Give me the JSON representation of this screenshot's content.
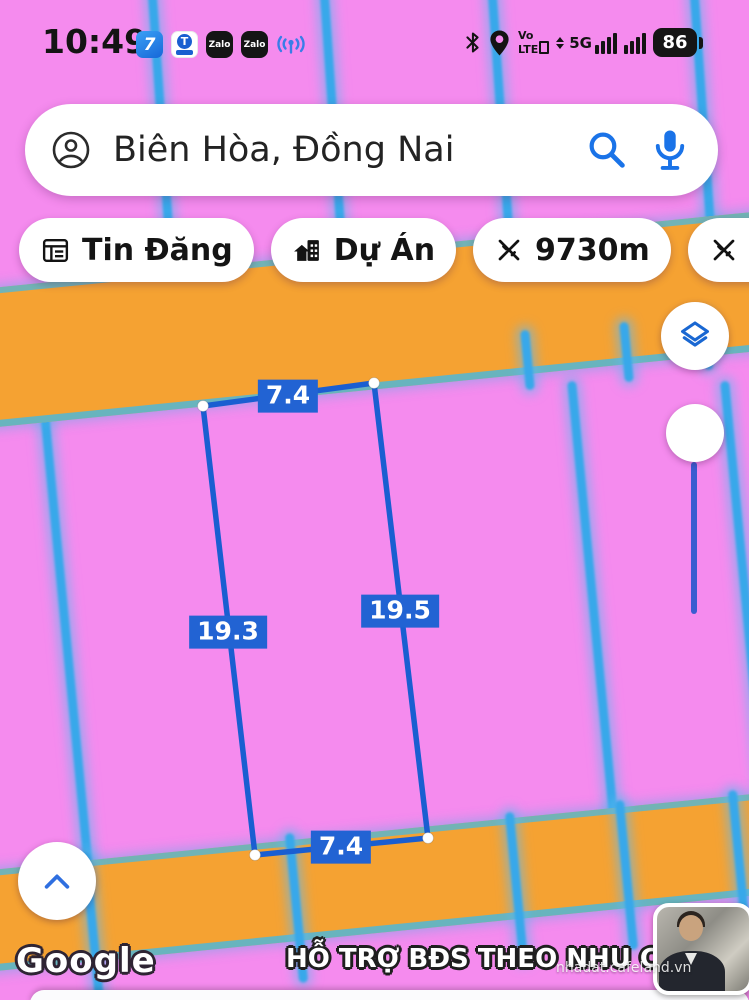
{
  "status_bar": {
    "time": "10:49",
    "app_icon_1_glyph": "7",
    "t_icon_letter": "T",
    "zalo_label": "Zalo",
    "volte_top": "Vo",
    "volte_bottom": "LTE",
    "five_g": "5G",
    "battery": "86"
  },
  "search": {
    "query": "Biên Hòa, Đồng Nai"
  },
  "chips": [
    {
      "label": "Tin Đăng",
      "icon": "listing-icon"
    },
    {
      "label": "Dự Án",
      "icon": "project-icon"
    },
    {
      "label": "9730m",
      "icon": "measure-icon"
    },
    {
      "label": "5000m",
      "icon": "measure-icon"
    }
  ],
  "map": {
    "measurements": {
      "top_width": "7.4",
      "left_length": "19.3",
      "right_length": "19.5",
      "bottom_width": "7.4"
    },
    "colors": {
      "parcel_pink": "#f58bee",
      "road_orange": "#f5a232",
      "boundary_blue": "#38a8ea",
      "measure_blue": "#1a5ed1",
      "label_bg": "#2263d3"
    }
  },
  "icons": {
    "account": "person-in-circle",
    "search": "magnifier",
    "mic": "microphone",
    "layers": "stacked-diamond",
    "scroll_top": "chevron-up",
    "bluetooth": "bluetooth-rune",
    "location": "map-pin",
    "measure": "crossed-rulers"
  },
  "footer": {
    "google_logo": "Google",
    "banner": "HỖ TRỢ BĐS THEO NHU CẦU",
    "watermark": "nhadat.cafeland.vn"
  }
}
